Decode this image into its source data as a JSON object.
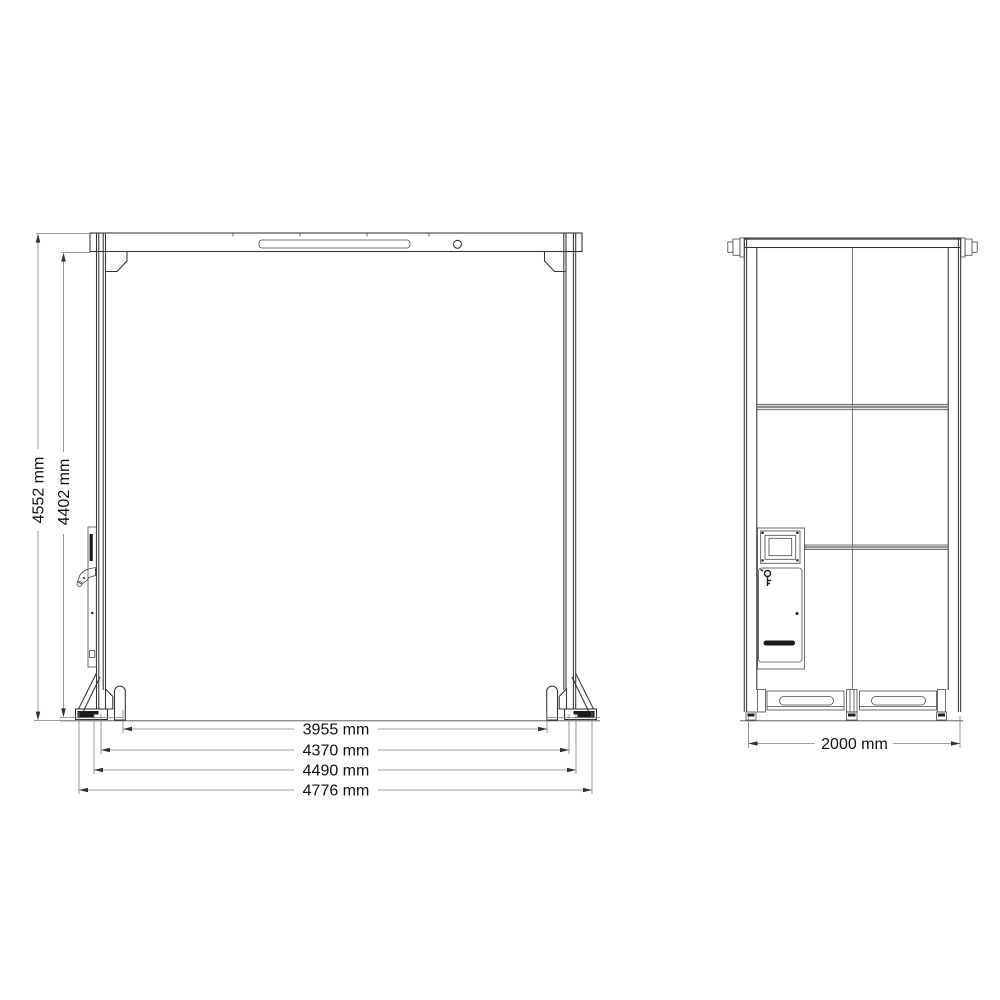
{
  "drawing": {
    "type": "engineering-dimension-drawing",
    "front_view": {
      "height_dimensions": [
        {
          "label": "4552 mm"
        },
        {
          "label": "4402 mm"
        }
      ],
      "width_dimensions": [
        {
          "label": "3955 mm"
        },
        {
          "label": "4370 mm"
        },
        {
          "label": "4490 mm"
        },
        {
          "label": "4776 mm"
        }
      ]
    },
    "side_view": {
      "width_dimensions": [
        {
          "label": "2000 mm"
        }
      ]
    },
    "colors": {
      "background": "#ffffff",
      "line": "#333333",
      "dimension_line": "#7f7f7f",
      "text": "#111111",
      "solid_detail": "#1c1c1c",
      "crossbar_fill": "#8f8f8f"
    }
  }
}
